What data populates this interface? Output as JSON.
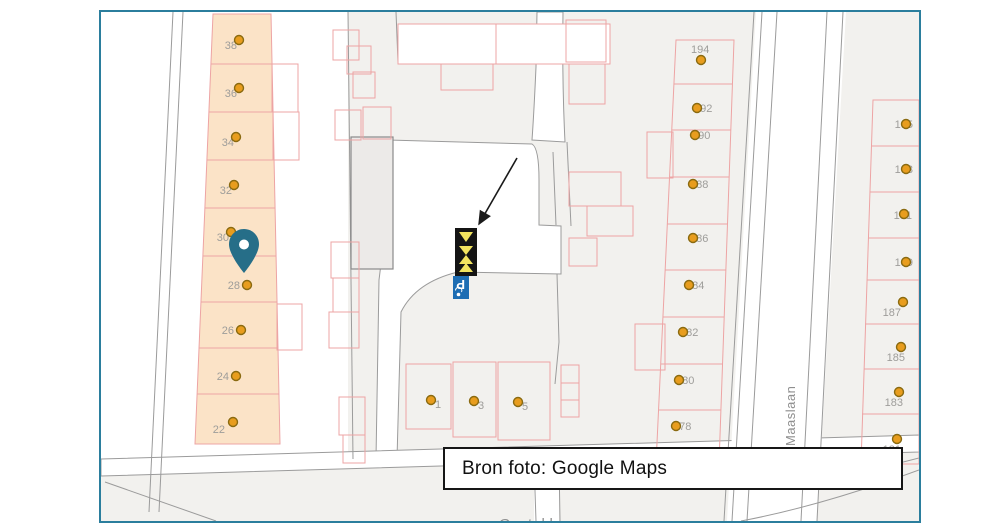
{
  "frame": {
    "border_color": "#2b7e9d"
  },
  "caption": {
    "text": "Bron foto: Google Maps"
  },
  "streets": {
    "maaslaan": "Maaslaan",
    "gastakker": "Gastakker"
  },
  "markers": {
    "parking_sign_letter": "P"
  },
  "houses": {
    "left": [
      "38",
      "36",
      "34",
      "32",
      "30",
      "28",
      "26",
      "24",
      "22"
    ],
    "middle": [
      "194",
      "192",
      "190",
      "188",
      "186",
      "184",
      "182",
      "180",
      "178"
    ],
    "right": [
      "195",
      "193",
      "191",
      "189",
      "187",
      "185",
      "183",
      "181"
    ],
    "bottom": [
      "1",
      "3",
      "5"
    ]
  },
  "colors": {
    "parcel_outline": "#eda4a4",
    "highlight_strip": "#fbe3c7",
    "dot_fill": "#e89d1e",
    "dot_ring": "#8a6a10",
    "pin": "#266e88",
    "parking_sign_blue": "#1d6db3",
    "marker_black": "#141414",
    "marker_yellow": "#f2e45f",
    "road_line": "#9b9b9b"
  }
}
